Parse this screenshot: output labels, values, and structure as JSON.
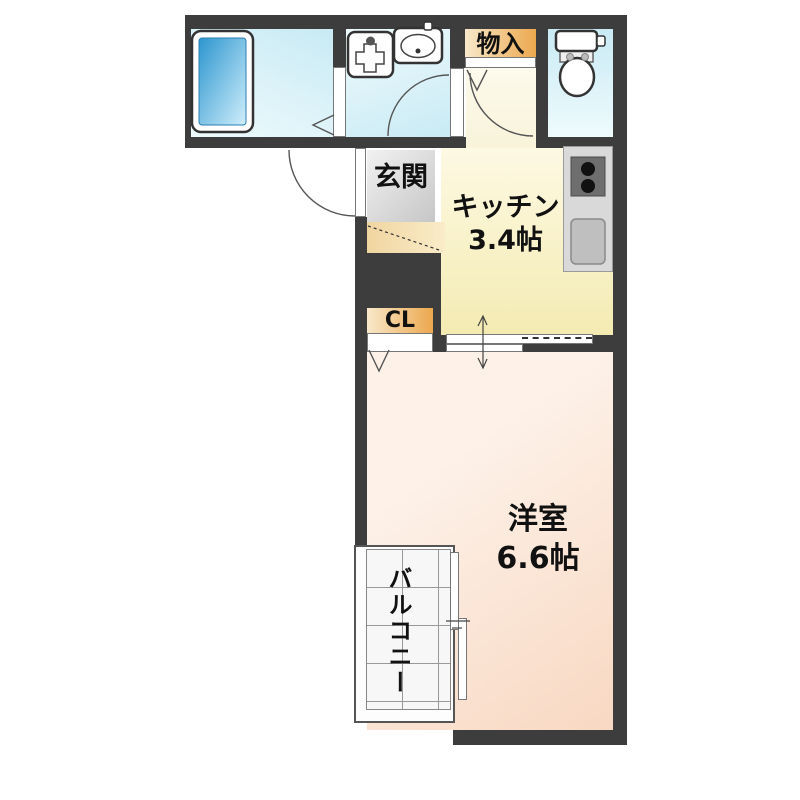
{
  "colors": {
    "wall": "#3d3d3d",
    "water-deep": "#c9eaf4",
    "water-light": "#eefbfd",
    "hall-light": "#fdfbf0",
    "hall-deep": "#f8f3d9",
    "kitchen-light": "#fdf9e3",
    "kitchen-deep": "#f4ebb2",
    "room-light": "#fdf1e8",
    "room-deep": "#f8d8c2",
    "orange-light": "#f8e8ca",
    "orange-deep": "#eca84e",
    "step-deep": "#f0d5a0",
    "step-light": "#faecc9",
    "gray-light": "#f2f2f2",
    "gray-deep": "#c6c6c6",
    "tub-deep": "#2d96cf",
    "tub-light": "#cfeefb",
    "counter": "#d9d9d9",
    "stove": "#6e6e6e",
    "sink-gray": "#bfbfbf"
  },
  "labels": {
    "storage": "物入",
    "entrance": "玄関",
    "kitchen": "キッチン",
    "kitchen_size": "3.4帖",
    "closet": "CL",
    "room": "洋室",
    "room_size": "6.6帖",
    "balcony": "バルコニー"
  },
  "fixtures": {
    "bathtub": "bathtub-icon",
    "washing_machine_pan": "washing-machine-pan-icon",
    "washbasin": "washbasin-icon",
    "toilet": "toilet-icon",
    "stove": "stove-icon",
    "kitchen_sink": "kitchen-sink-icon"
  }
}
